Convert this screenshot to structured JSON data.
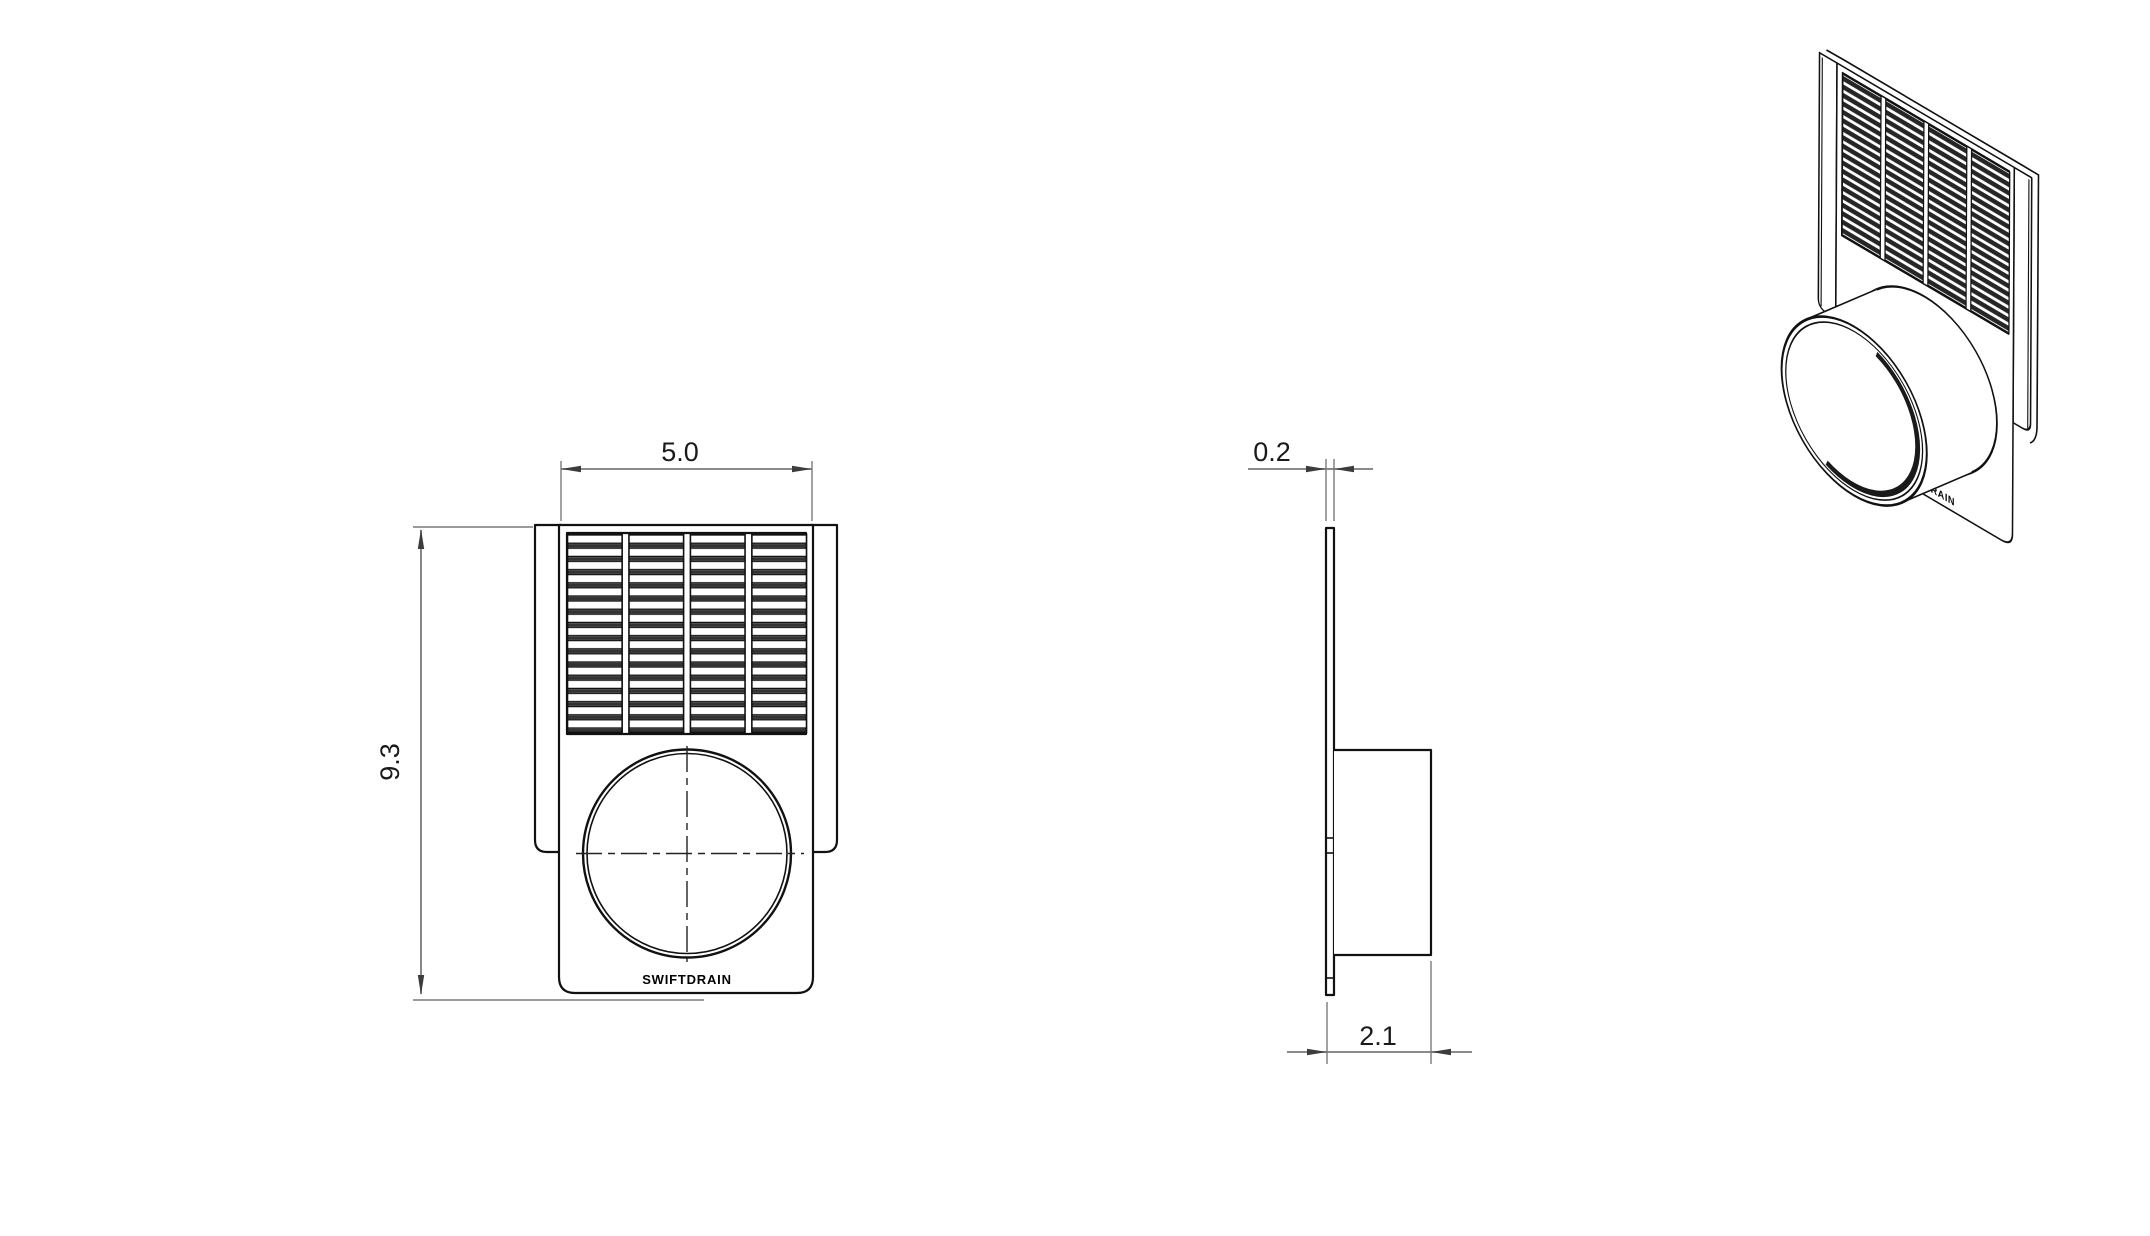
{
  "drawing": {
    "brand": "SWIFTDRAIN",
    "dimensions": {
      "front_width": "5.0",
      "front_height": "9.3",
      "plate_thickness": "0.2",
      "total_depth": "2.1"
    },
    "colors": {
      "background": "#ffffff",
      "part_line": "#111111",
      "dimension_line": "#7a7a7a",
      "slat_shadow": "#333333",
      "text": "#1a1a1a"
    }
  }
}
